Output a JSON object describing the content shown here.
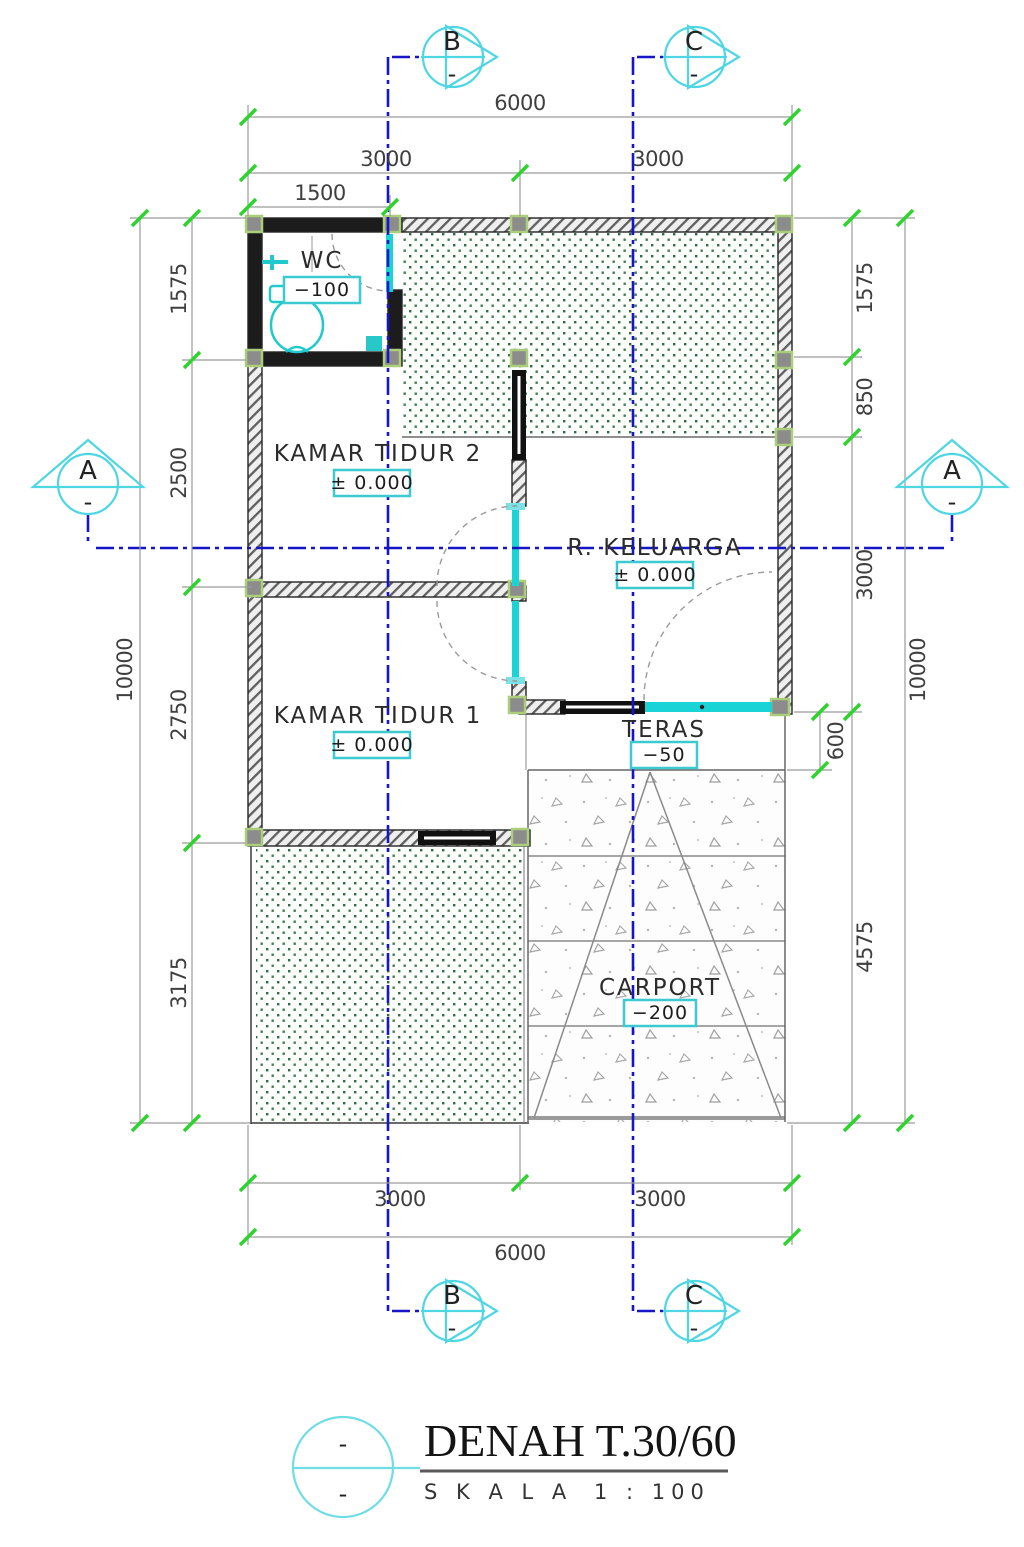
{
  "title_block": {
    "title": "DENAH T.30/60",
    "scale_label": "S K A L A",
    "scale_value": "1 : 100",
    "rev": "-"
  },
  "grid_markers": {
    "a": "A",
    "b": "B",
    "c": "C",
    "sub": "-"
  },
  "rooms": [
    {
      "name": "WC",
      "elevation": "−100"
    },
    {
      "name": "KAMAR TIDUR 2",
      "elevation": "± 0.000"
    },
    {
      "name": "R. KELUARGA",
      "elevation": "± 0.000"
    },
    {
      "name": "KAMAR TIDUR 1",
      "elevation": "± 0.000"
    },
    {
      "name": "TERAS",
      "elevation": "−50"
    },
    {
      "name": "CARPORT",
      "elevation": "−200"
    }
  ],
  "dimensions": {
    "top": {
      "total": "6000",
      "seg1": "3000",
      "seg2": "3000",
      "sub": "1500"
    },
    "bottom": {
      "total": "6000",
      "seg1": "3000",
      "seg2": "3000"
    },
    "left": {
      "total": "10000",
      "s1": "1575",
      "s2": "2500",
      "s3": "2750",
      "s4": "3175"
    },
    "right": {
      "total": "10000",
      "s1": "1575",
      "s2": "850",
      "s3": "3000",
      "s4": "4575",
      "teras_depth": "600"
    }
  },
  "colors": {
    "accent_cyan": "#35cbd4",
    "door_cyan": "#19d3d6",
    "centerline_blue": "#1616c8",
    "tick_green": "#2ed32e",
    "garden_dot_green": "#35694a",
    "column_outline": "#aace7a"
  }
}
